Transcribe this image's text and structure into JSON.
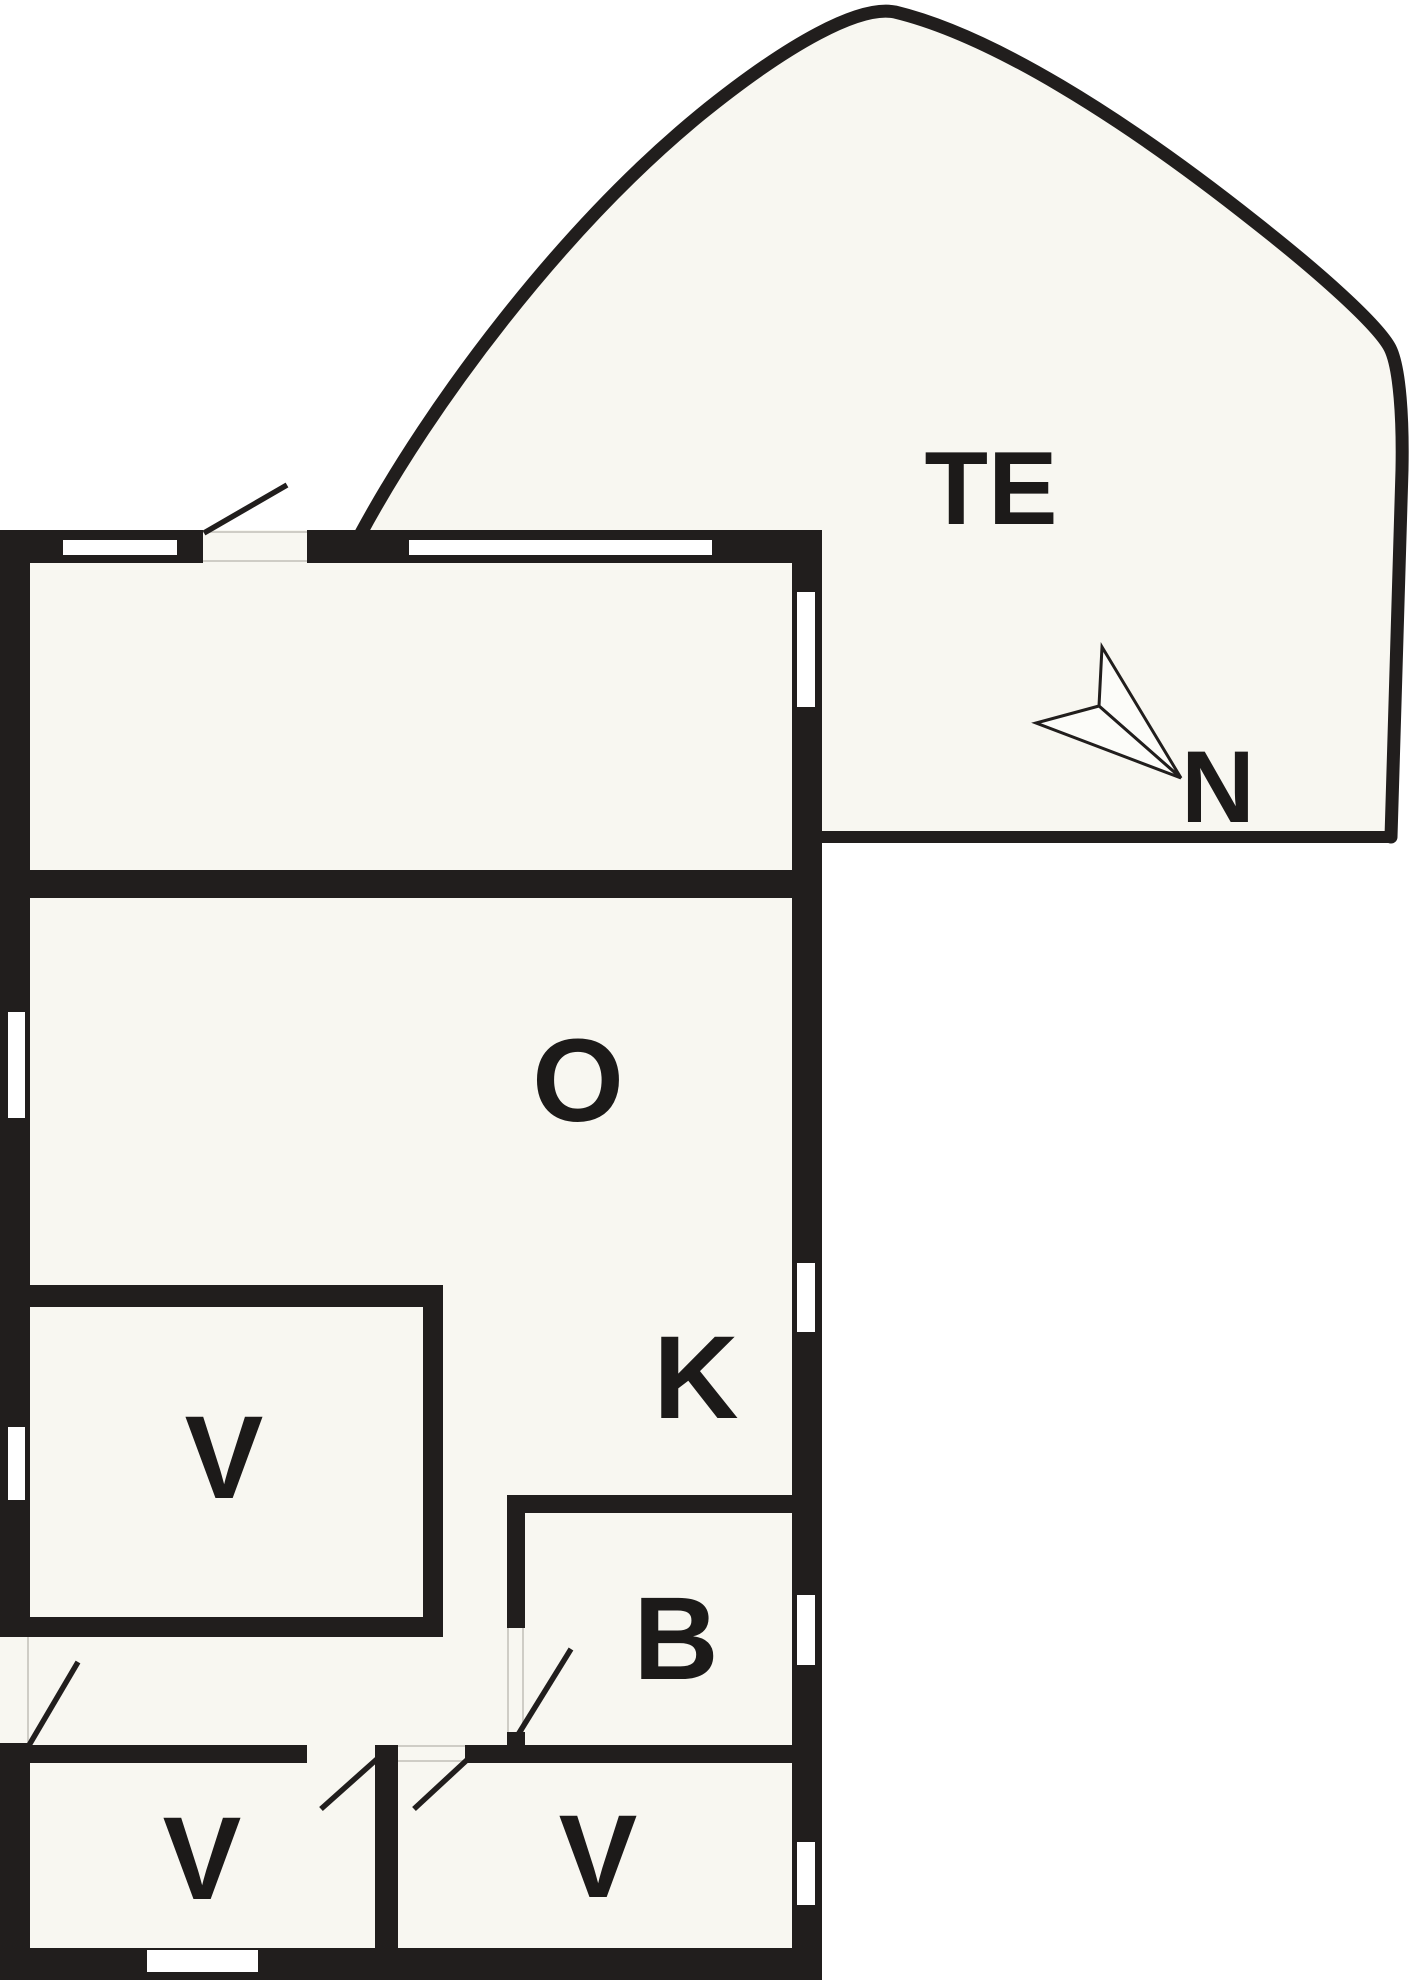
{
  "labels": {
    "terrace": "TE",
    "north": "N",
    "room_o": "O",
    "room_k": "K",
    "room_v_main": "V",
    "room_b": "B",
    "room_v_bottom_left": "V",
    "room_v_bottom_right": "V"
  },
  "colors": {
    "background": "#ffffff",
    "floor": "#f8f7f1",
    "wall": "#211e1d",
    "label": "#1c1a19",
    "threshold": "#cfcdc6",
    "compass_fill": "#fcfcf9"
  }
}
